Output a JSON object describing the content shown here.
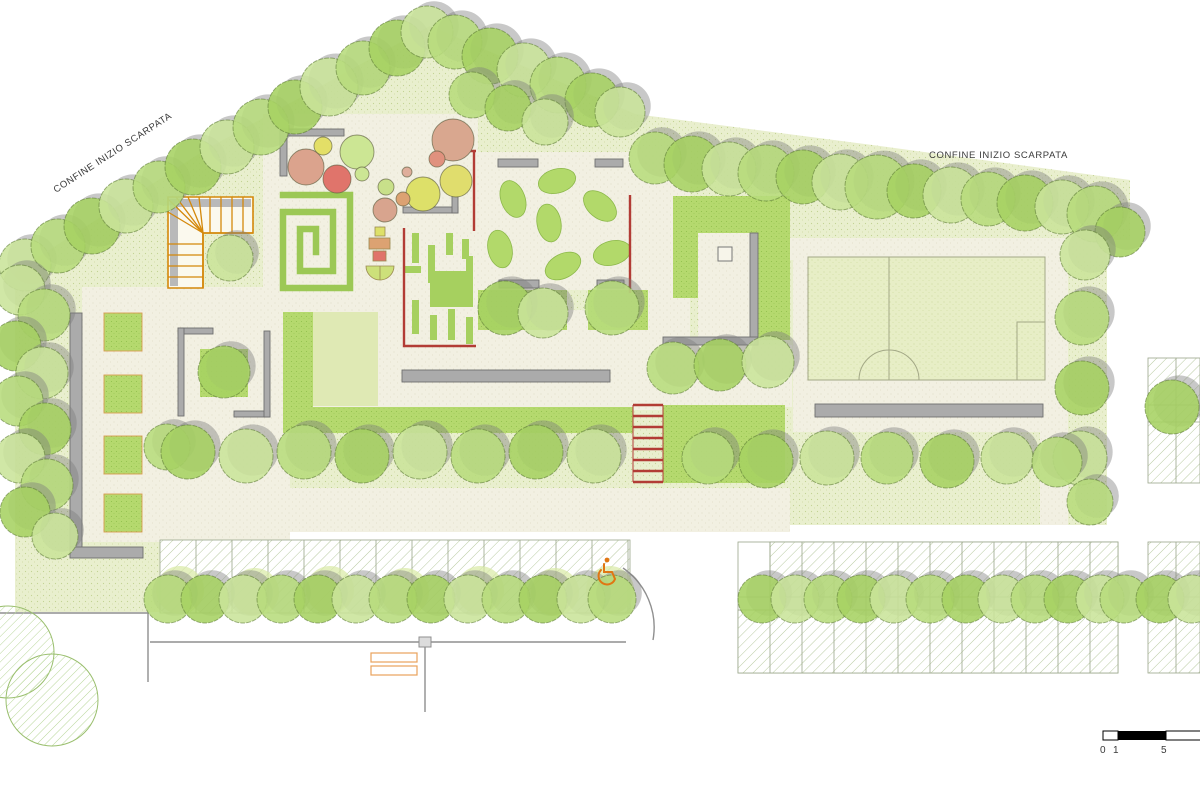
{
  "document": {
    "type": "landscape-site-plan"
  },
  "labels": {
    "boundary_left": "CONFINE  INIZIO SCARPATA",
    "boundary_right": "CONFINE INIZIO SCARPATA"
  },
  "scale_bar": {
    "t0": "0",
    "t1": "1",
    "t5": "5"
  },
  "icons": {
    "accessibility": "wheelchair-icon"
  },
  "colors": {
    "park_green": "#e9efce",
    "hedge_green": "#b5d96e",
    "lawn_green": "#dfe9b4",
    "path_cream": "#f2f0e2",
    "accent_red": "#b23c35",
    "accent_orange": "#d98a12",
    "wall_gray": "#a9a9a9",
    "accessibility_orange": "#e07613"
  }
}
